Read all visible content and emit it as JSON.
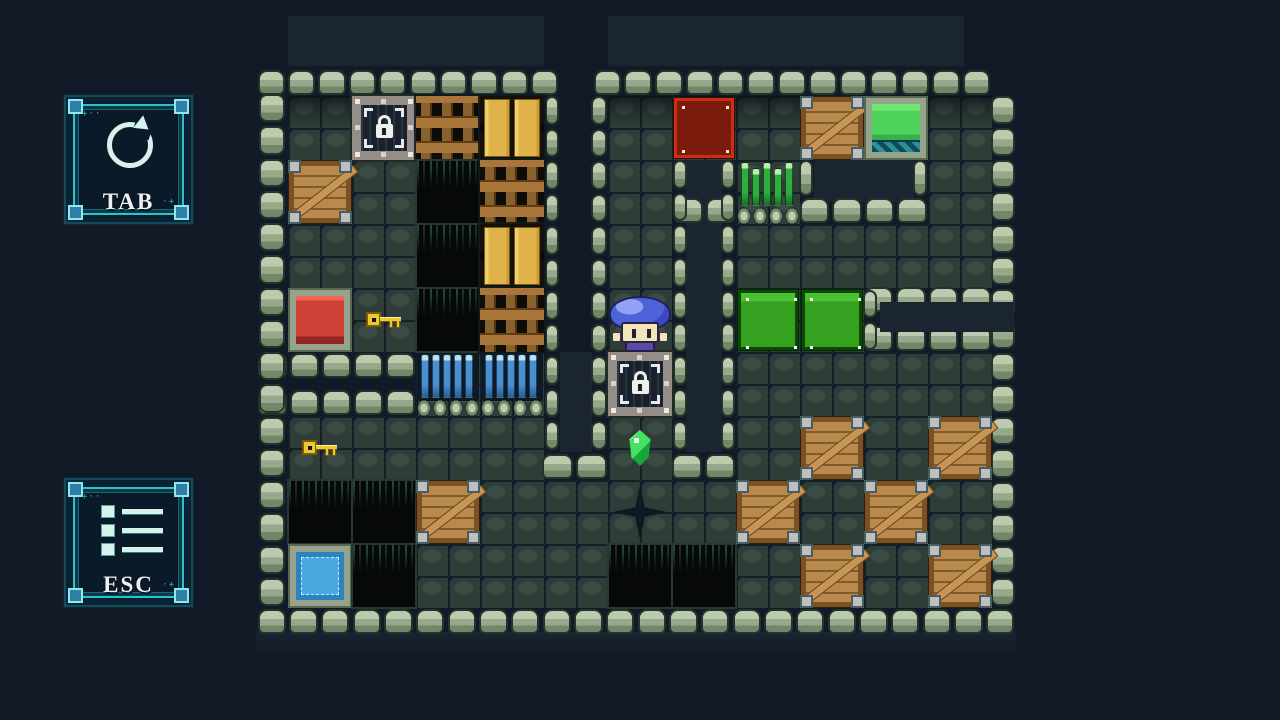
{
  "ui": {
    "buttons": [
      {
        "id": "tab-button",
        "label": "TAB",
        "icon": "restart-icon",
        "deco_tl": "+··",
        "deco_br": "·+"
      },
      {
        "id": "esc-button",
        "label": "ESC",
        "icon": "menu-icon",
        "deco_tl": "+··",
        "deco_br": "·+"
      }
    ]
  },
  "palette": {
    "bg": "#121a28",
    "band": "#1a2531",
    "bumpHi": "#bccaae",
    "bumpMid": "#95a98b",
    "bumpLo": "#72866a",
    "bumpLine": "#26322a",
    "stone": "#2e3d37",
    "stoneHi": "#3b4b43",
    "stoneGap": "#132029",
    "crate": "#b98a4d",
    "crateDark": "#7c5022",
    "crateLight": "#c49757",
    "crateLine": "#33200a",
    "metal": "#b9c2c2",
    "metalLine": "#4e5a60",
    "wood": "#a8763a",
    "woodDark": "#5f3c14",
    "orange": "#dfb24a",
    "orangeHi": "#f0cd6d",
    "orangeLine": "#7a5a10",
    "redGoal": "#7c1a0c",
    "redGoalLine": "#cb2d15",
    "redPlate": "#cd4136",
    "redPlateHi": "#ef6a55",
    "redPlateLo": "#932420",
    "frame": "#95a38c",
    "frameLine": "#57684f",
    "green": "#36a021",
    "greenHi": "#4cc033",
    "greenLine": "#0b4a05",
    "greenDoor": "#4fd45b",
    "teal": "#2a8fa0",
    "tealDark": "#134b56",
    "water": "#49aade",
    "waterLo": "#2e82c0",
    "waterDash": "#c2ecf8",
    "pit": "#060908",
    "pitLine": "#24392f",
    "pitStreak": "#284638",
    "spikeBlue": "#4a8fd0",
    "spikeBlueHi": "#b7e2f4",
    "spikeGreen": "#2fae3e",
    "spikeGreenHi": "#b9f0b0",
    "key": "#edc92e",
    "keyLine": "#7c5c06",
    "gem": "#43e261",
    "cap": "#4f63d8",
    "capHi": "#92a2f4",
    "capLine": "#1c2260",
    "face": "#f3e5bb",
    "robe": "#5c49a2",
    "uiBg": "#0a1a29",
    "uiBright": "#2cc4cc",
    "uiCorner": "#2e7fa3",
    "uiCornerHi": "#8fe8f0",
    "uiIcon": "#d6f2ea",
    "uiDeco": "#2fd3d8",
    "text": "#efefef"
  },
  "map": {
    "origin": [
      288,
      32
    ],
    "tile": 64,
    "floors": [
      [
        288,
        96,
        256,
        256,
        1
      ],
      [
        416,
        352,
        128,
        64,
        0
      ],
      [
        288,
        416,
        256,
        64,
        0
      ],
      [
        608,
        96,
        64,
        384,
        1
      ],
      [
        672,
        96,
        320,
        64,
        1
      ],
      [
        736,
        160,
        64,
        64,
        0
      ],
      [
        928,
        160,
        64,
        128,
        0
      ],
      [
        736,
        224,
        256,
        64,
        0
      ],
      [
        736,
        288,
        128,
        64,
        0
      ],
      [
        736,
        352,
        256,
        128,
        0
      ],
      [
        288,
        480,
        704,
        128,
        0
      ]
    ],
    "dark": [
      [
        288,
        16,
        256,
        50,
        0
      ],
      [
        608,
        16,
        356,
        50,
        0
      ],
      [
        686,
        160,
        36,
        292,
        0
      ],
      [
        814,
        160,
        100,
        42,
        0
      ],
      [
        560,
        352,
        32,
        100,
        0
      ],
      [
        880,
        302,
        134,
        30,
        1
      ],
      [
        256,
        632,
        760,
        22,
        2
      ]
    ],
    "walls": [
      [
        256,
        64,
        304,
        32,
        "h",
        "b"
      ],
      [
        592,
        64,
        400,
        32,
        "h",
        "b"
      ],
      [
        256,
        352,
        160,
        28,
        "h",
        "t"
      ],
      [
        256,
        386,
        160,
        30,
        "h",
        "b"
      ],
      [
        540,
        450,
        68,
        30,
        "h",
        "b"
      ],
      [
        670,
        450,
        66,
        30,
        "h",
        "b"
      ],
      [
        672,
        194,
        64,
        30,
        "h",
        "b"
      ],
      [
        798,
        194,
        130,
        30,
        "h",
        "b"
      ],
      [
        862,
        286,
        130,
        24,
        "h",
        "t"
      ],
      [
        862,
        330,
        130,
        22,
        "h",
        "b"
      ],
      [
        256,
        608,
        760,
        30,
        "h",
        "t"
      ],
      [
        258,
        92,
        28,
        516,
        "v",
        ""
      ],
      [
        544,
        94,
        16,
        358,
        "v",
        ""
      ],
      [
        590,
        94,
        18,
        358,
        "v",
        ""
      ],
      [
        672,
        158,
        16,
        294,
        "v",
        ""
      ],
      [
        720,
        158,
        16,
        294,
        "v",
        ""
      ],
      [
        798,
        158,
        16,
        40,
        "v",
        ""
      ],
      [
        912,
        158,
        16,
        40,
        "v",
        ""
      ],
      [
        862,
        288,
        16,
        64,
        "v",
        ""
      ],
      [
        990,
        94,
        26,
        514,
        "v",
        ""
      ]
    ],
    "objects": [
      [
        "lock",
        1,
        1
      ],
      [
        "lattice",
        2,
        1
      ],
      [
        "door_orange",
        3,
        1
      ],
      [
        "crate",
        0,
        2
      ],
      [
        "pit",
        2,
        2
      ],
      [
        "lattice",
        3,
        2
      ],
      [
        "pit",
        2,
        3
      ],
      [
        "door_orange",
        3,
        3
      ],
      [
        "plate_red",
        0,
        4
      ],
      [
        "key",
        1,
        4
      ],
      [
        "pit",
        2,
        4
      ],
      [
        "lattice",
        3,
        4
      ],
      [
        "spikes_blue",
        2,
        5
      ],
      [
        "spikes_blue",
        3,
        5
      ],
      [
        "key",
        0,
        6
      ],
      [
        "pit",
        0,
        7
      ],
      [
        "pit",
        1,
        7
      ],
      [
        "crate",
        2,
        7
      ],
      [
        "water_blue",
        0,
        8
      ],
      [
        "pit",
        1,
        8
      ],
      [
        "player",
        5,
        4
      ],
      [
        "lock",
        5,
        5
      ],
      [
        "gem",
        5,
        6
      ],
      [
        "crack",
        5,
        7
      ],
      [
        "pit",
        5,
        8
      ],
      [
        "goal_red",
        6,
        1
      ],
      [
        "pit",
        6,
        8
      ],
      [
        "spikes_green",
        7,
        2
      ],
      [
        "block_green",
        7,
        4
      ],
      [
        "crate",
        7,
        7
      ],
      [
        "crate",
        8,
        1
      ],
      [
        "block_green",
        8,
        4
      ],
      [
        "crate",
        8,
        6
      ],
      [
        "crate",
        8,
        8
      ],
      [
        "door_green",
        9,
        1
      ],
      [
        "crate",
        9,
        7
      ],
      [
        "crate",
        10,
        6
      ],
      [
        "crate",
        10,
        8
      ]
    ]
  }
}
